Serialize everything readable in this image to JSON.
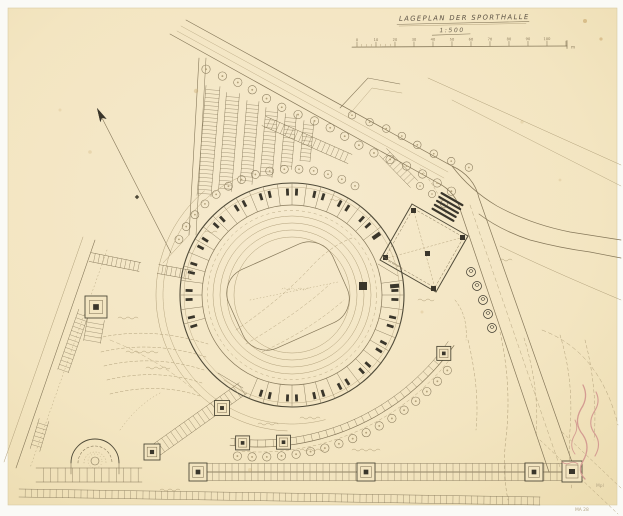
{
  "title_block": {
    "title": "LAGEPLAN DER SPORTHALLE",
    "scale": "1:500",
    "scale_bar": {
      "tick_labels": [
        "0",
        "10",
        "20",
        "30",
        "40",
        "50",
        "60",
        "70",
        "80",
        "90",
        "100"
      ],
      "unit": "m"
    }
  },
  "annotations": {
    "corner_mark_1": "Mpl",
    "corner_mark_2": "MA 28"
  },
  "colors": {
    "scan_background": "#fafaf6",
    "paper": "#f3e5c1",
    "paper_light": "#f6eace",
    "paper_edge": "#d8cba3",
    "pencil_faint": "#b1a07a",
    "pencil": "#857759",
    "pencil_dark": "#4f4a38",
    "ink": "#3a362b",
    "red_note": "#d49b92",
    "stain": "#c09a5a"
  }
}
